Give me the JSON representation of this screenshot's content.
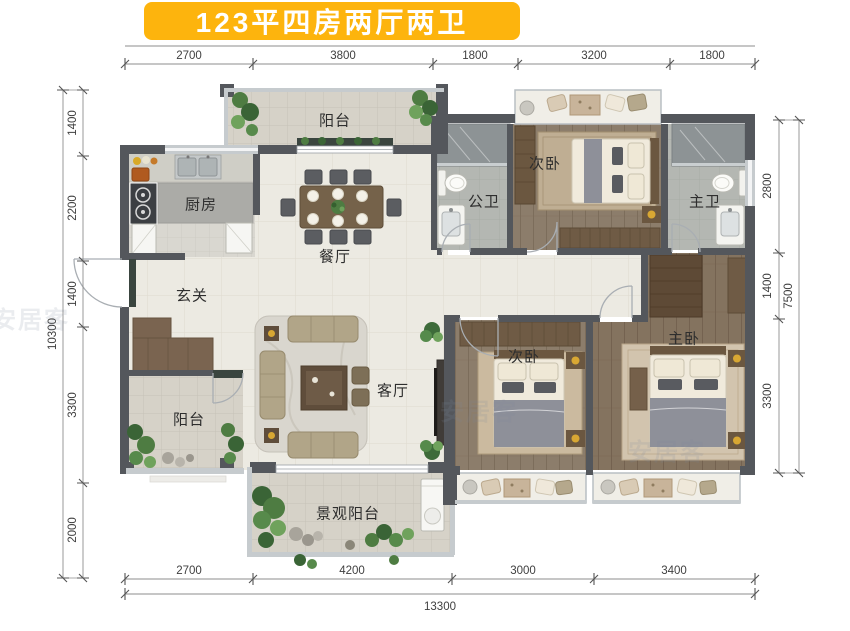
{
  "title": {
    "text": "123平四房两厅两卫"
  },
  "colors": {
    "banner_bg": "#FDB40D",
    "banner_text": "#FFFFFF",
    "wall": "#54575C",
    "marble_accent": "#3A453F",
    "tile_floor": "#ECEAE2",
    "balcony_floor": "#D6D2C8",
    "bath_floor": "#B4B7B2",
    "wood_floor": "#8C7D6B",
    "wood_floor_master": "#84735F",
    "gold_accent": "#D8A733",
    "plant_green": "#4E7C42",
    "dim_text": "#3F3F3F"
  },
  "rooms": {
    "balcony_top": {
      "label": "阳台"
    },
    "kitchen": {
      "label": "厨房"
    },
    "dining": {
      "label": "餐厅"
    },
    "entry": {
      "label": "玄关"
    },
    "public_bath": {
      "label": "公卫"
    },
    "bedroom_top": {
      "label": "次卧"
    },
    "master_bath": {
      "label": "主卫"
    },
    "living": {
      "label": "客厅"
    },
    "balcony_left": {
      "label": "阳台"
    },
    "bedroom_second": {
      "label": "次卧"
    },
    "master_bedroom": {
      "label": "主卧"
    },
    "balcony_view": {
      "label": "景观阳台"
    }
  },
  "dims": {
    "top": [
      "2700",
      "3800",
      "1800",
      "3200",
      "1800"
    ],
    "bottom": [
      "2700",
      "4200",
      "3000",
      "3400"
    ],
    "bottom_total": "13300",
    "left": [
      "1400",
      "2200",
      "1400",
      "3300",
      "2000"
    ],
    "left_total": "10300",
    "right": [
      "2800",
      "1400",
      "3300"
    ],
    "right_total": "7500"
  },
  "watermark": {
    "text": "安居客"
  }
}
